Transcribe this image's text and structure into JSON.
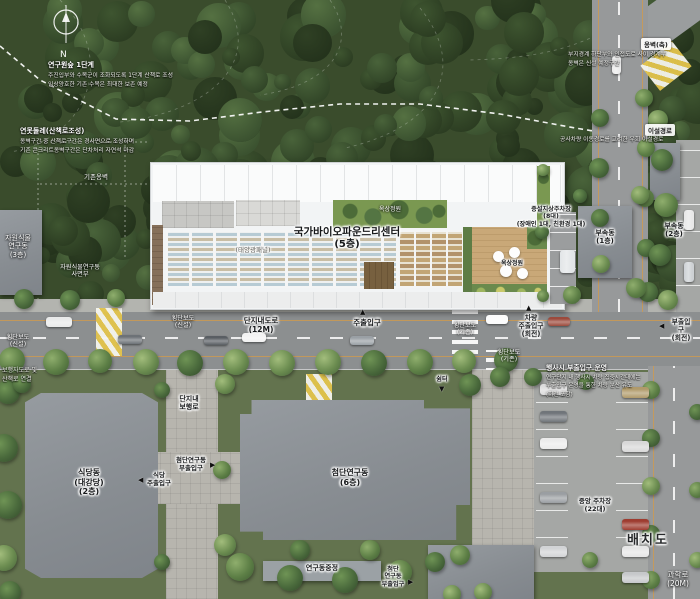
{
  "plan_title": "배치도",
  "compass_n": "N",
  "icons": {
    "up": "▲",
    "down": "▼",
    "left": "◀",
    "right": "▶"
  },
  "site": {
    "name": "국가바이오파운드리센터",
    "floors": "(5층)",
    "solar_panel": "(태양광패널)",
    "roof_garden": "옥상정원",
    "deck_garden": "옥상정원",
    "existing_wall": "기존옹벽",
    "added_parking": "증설지상주차장\n(8대)\n(장애인 1대, 친환경 1대)"
  },
  "buildings": {
    "annex1": "부속동\n(1층)",
    "annex2": "부속동\n(2층)",
    "plant_lab": "자원식물\n연구동\n(3층)",
    "slope_zone": "자원식물연구동\n사면부",
    "cafeteria": "식당동\n(대강당)\n(2층)",
    "advanced_lab": "첨단연구동\n(6층)",
    "courtyard": "연구동중정",
    "shelter": "쉼터"
  },
  "roads": {
    "complex_road": "단지내도로\n(12M)",
    "science_road": "과학로\n(20M)",
    "walkway": "단지내\n보행로",
    "crosswalk_new_1": "횡단보도\n(신설)",
    "crosswalk_new_2": "횡단보도\n(신설)",
    "crosswalk_old_1": "횡단보도\n(기존)",
    "crosswalk_old_2": "횡단보도\n(기존)",
    "central_parking": "중앙 주차장\n(22대)"
  },
  "entrances": {
    "main": "주출입구",
    "vehicle_main": "차량\n주출입구\n(회전)",
    "sub": "부출입구\n(회전)",
    "cafeteria_main": "식당\n주출입구",
    "advanced_sub": "첨단연구동\n부출입구",
    "advanced_sub_2": "첨단\n연구동\n부출입구"
  },
  "notes": {
    "n1_title": "연구원숲 1단계",
    "n1_body": "주진입부와 수목군이 조화되도록 1단계 산책로 조성\n임상양호한 기존 수목은 최대한 보존 예정",
    "n2_title": "연못둘레(산책로조성)",
    "n2_body": "옹벽구간 중 산책로구간은 경사면으로 조성하며\n기존 콘크리트옹벽구간은 단차처리 자연석 마감",
    "n3_title": "옹벽(축)",
    "n3_body": "부지경계 하단부와 인접도로 사이 경계부\n옹벽은 신설 예정구간",
    "n4_title": "이설경로",
    "n4_body": "공사차량 이동경로를 고려한 우회 이설경로",
    "n5_title": "행사시 부출입구 운영",
    "n5_body": "연구단지 내 행사시 차량 집중시간대에는\n부출입구 운영을 통한 차량 분산 유도\n(회전 포함)",
    "n6": "보행자도로 및\n산책로 연결"
  },
  "colors": {
    "forest": "#3a4c2c",
    "road": "#8c8f90",
    "building": "#8d9297",
    "site": "#f2f4f5",
    "deck_wood": "#c9a878",
    "roof_green": "#7a9851",
    "crosswalk_yellow": "#e3c44c",
    "lane_orange": "#cf9a4e"
  }
}
